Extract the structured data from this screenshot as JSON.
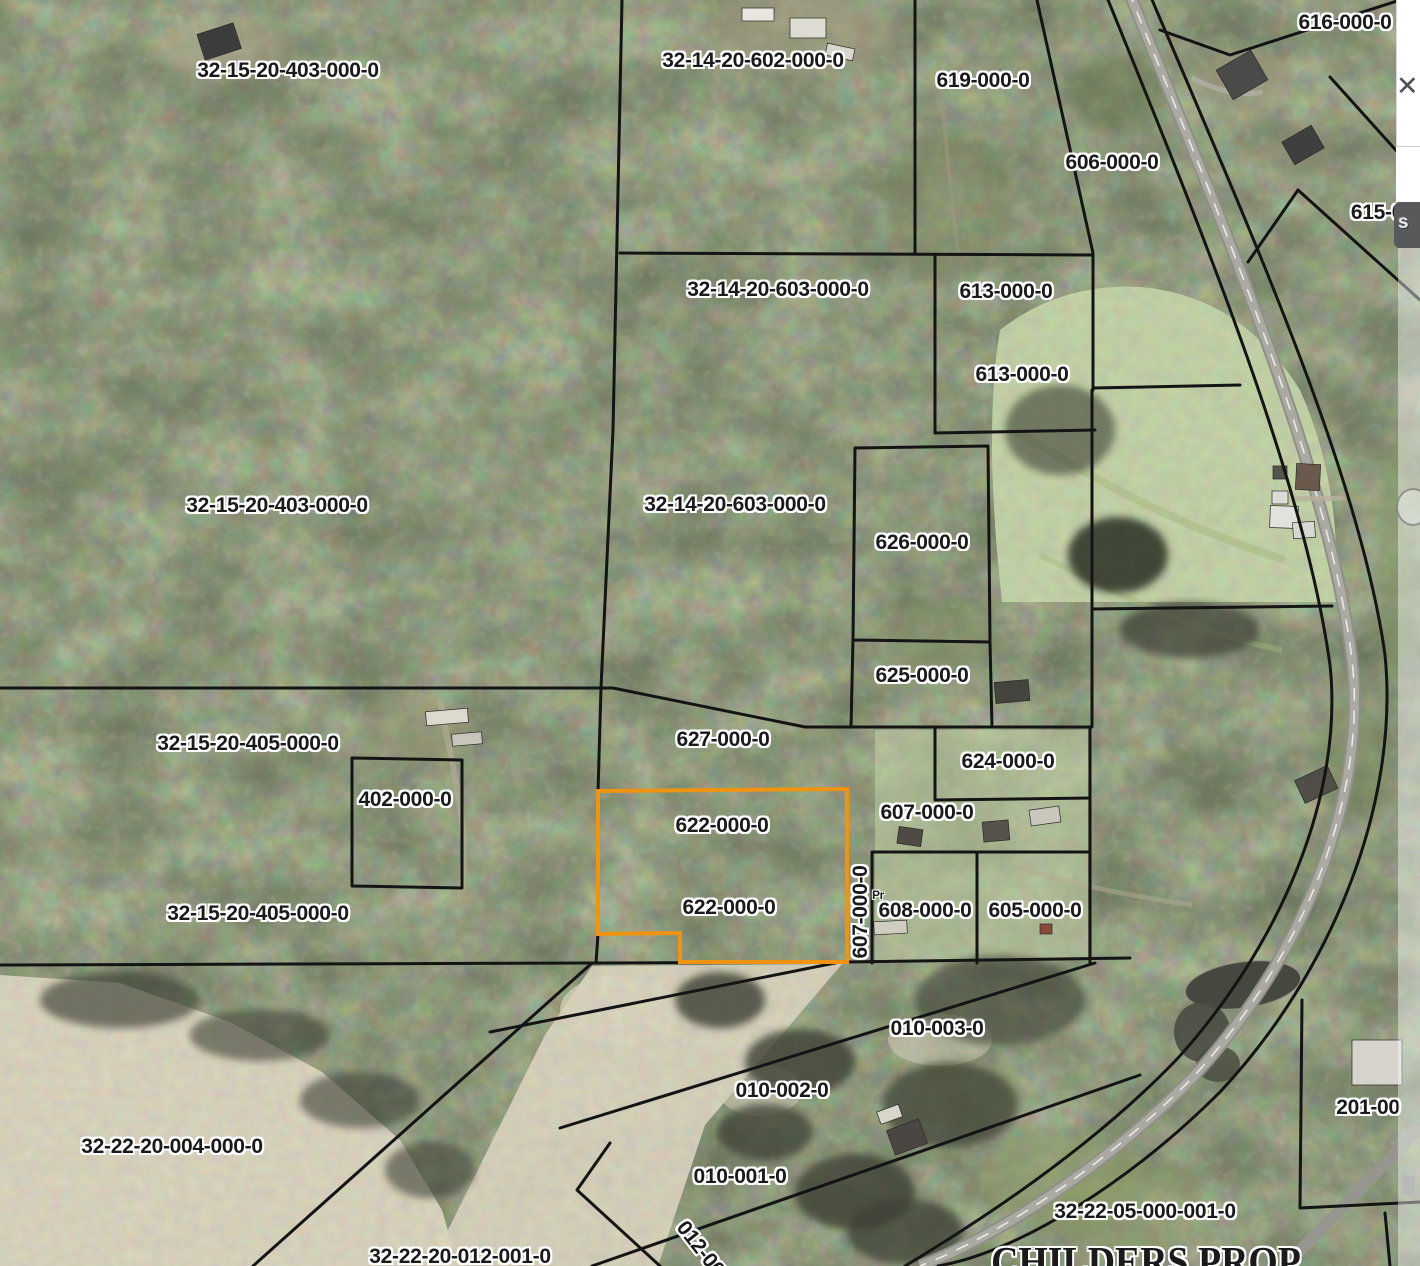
{
  "map": {
    "selected_parcel": "622-000-0",
    "highlight_color": "#ef9412",
    "label_color": "#1a1a1a",
    "label_halo": "#ffffff",
    "road_color": "#aaaaa2",
    "labels": [
      {
        "text": "32-15-20-403-000-0"
      },
      {
        "text": "32-14-20-602-000-0"
      },
      {
        "text": "619-000-0"
      },
      {
        "text": "616-000-0"
      },
      {
        "text": "606-000-0"
      },
      {
        "text": "615-0"
      },
      {
        "text": "32-14-20-603-000-0"
      },
      {
        "text": "613-000-0"
      },
      {
        "text": "613-000-0"
      },
      {
        "text": "32-15-20-403-000-0"
      },
      {
        "text": "32-14-20-603-000-0"
      },
      {
        "text": "626-000-0"
      },
      {
        "text": "625-000-0"
      },
      {
        "text": "627-000-0"
      },
      {
        "text": "624-000-0"
      },
      {
        "text": "32-15-20-405-000-0"
      },
      {
        "text": "402-000-0"
      },
      {
        "text": "622-000-0"
      },
      {
        "text": "607-000-0"
      },
      {
        "text": "622-000-0"
      },
      {
        "text": "607-000-0"
      },
      {
        "text": "608-000-0"
      },
      {
        "text": "605-000-0"
      },
      {
        "text": "32-15-20-405-000-0"
      },
      {
        "text": "010-003-0"
      },
      {
        "text": "010-002-0"
      },
      {
        "text": "010-001-0"
      },
      {
        "text": "32-22-20-004-000-0"
      },
      {
        "text": "32-22-20-012-001-0"
      },
      {
        "text": "012-00"
      },
      {
        "text": "32-22-05-000-001-0"
      },
      {
        "text": "201-00"
      },
      {
        "text": "Pr"
      },
      {
        "text": "CHILDERS PROP"
      }
    ]
  },
  "ui": {
    "close_glyph": "✕",
    "panel_fragment": "s"
  }
}
